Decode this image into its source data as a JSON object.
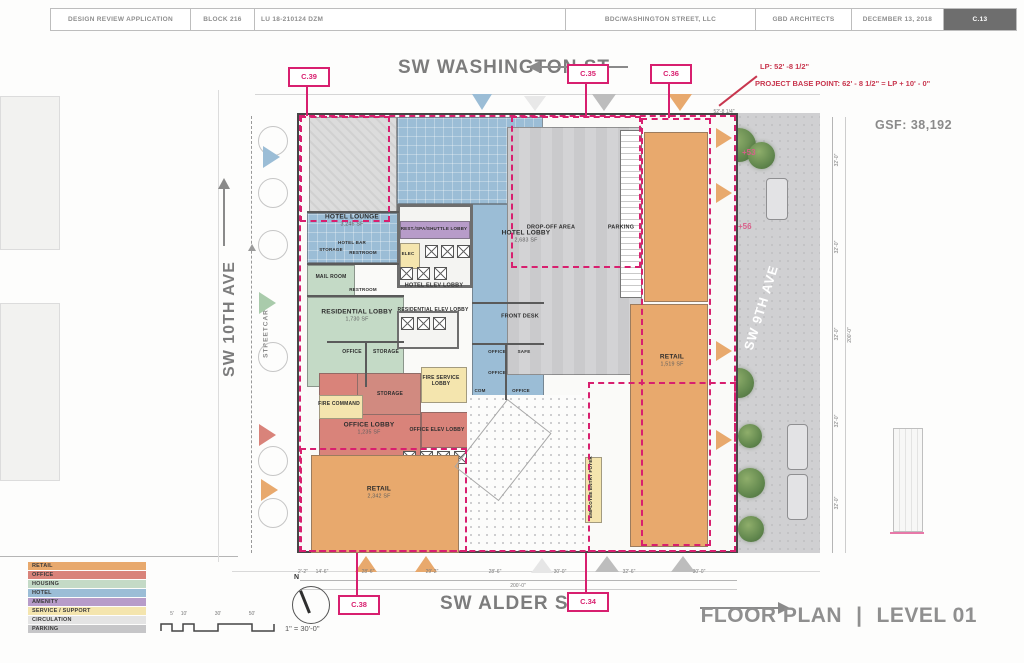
{
  "header": {
    "app": "DESIGN REVIEW APPLICATION",
    "block": "BLOCK 216",
    "case_no": "LU 18-210124 DZM",
    "owner": "BDC/WASHINGTON STREET, LLC",
    "architect": "GBD ARCHITECTS",
    "date": "DECEMBER 13, 2018",
    "sheet": "C.13"
  },
  "streets": {
    "north": "SW WASHINGTON ST",
    "south": "SW ALDER ST",
    "west": "SW 10TH AVE",
    "east": "SW 9TH AVE",
    "streetcar": "STREETCAR"
  },
  "callouts": {
    "c39": "C.39",
    "c35": "C.35",
    "c36": "C.36",
    "c38": "C.38",
    "c34": "C.34"
  },
  "annotations": {
    "lp": "LP: 52' -8 1/2\"",
    "base_point": "PROJECT BASE POINT: 62' - 8 1/2\" = LP + 10' - 0\"",
    "gsf": "GSF:  38,192",
    "spot_a": "+53",
    "spot_b": "+56",
    "top_dim": "52'-8 1/4\""
  },
  "rooms": {
    "hotel_lounge": {
      "label": "HOTEL LOUNGE",
      "sf": "3,246 SF"
    },
    "hotel_bar": {
      "label": "HOTEL BAR"
    },
    "storage_a": {
      "label": "STORAGE"
    },
    "restroom_a": {
      "label": "RESTROOM"
    },
    "restroom_b": {
      "label": "RESTROOM"
    },
    "mail_room": {
      "label": "MAIL ROOM"
    },
    "spa_lobby": {
      "label": "REST./SPA/SHUTTLE LOBBY"
    },
    "elec": {
      "label": "ELEC"
    },
    "hotel_lobby": {
      "label": "HOTEL LOBBY",
      "sf": "2,683 SF"
    },
    "hotel_elev_lobby": {
      "label": "HOTEL ELEV LOBBY"
    },
    "res_elev_lobby": {
      "label": "RESIDENTIAL ELEV LOBBY"
    },
    "res_lobby": {
      "label": "RESIDENTIAL LOBBY",
      "sf": "1,730 SF"
    },
    "office_a": {
      "label": "OFFICE"
    },
    "storage_b": {
      "label": "STORAGE"
    },
    "front_desk": {
      "label": "FRONT DESK"
    },
    "office_b": {
      "label": "OFFICE"
    },
    "safe": {
      "label": "SAFE"
    },
    "office_c": {
      "label": "OFFICE"
    },
    "com": {
      "label": "COM"
    },
    "office_d": {
      "label": "OFFICE"
    },
    "fire_service_lobby": {
      "label": "FIRE SERVICE LOBBY"
    },
    "storage_c": {
      "label": "STORAGE"
    },
    "fire_command": {
      "label": "FIRE COMMAND"
    },
    "office_lobby": {
      "label": "OFFICE LOBBY",
      "sf": "1,235 SF"
    },
    "office_elev_lobby": {
      "label": "OFFICE ELEV LOBBY"
    },
    "retail_sw": {
      "label": "RETAIL",
      "sf": "2,342 SF"
    },
    "dropoff": {
      "label": "DROP-OFF AREA"
    },
    "parking": {
      "label": "PARKING"
    },
    "retail_e": {
      "label": "RETAIL",
      "sf": "1,519 SF"
    },
    "employee_foyer": {
      "label": "EMPLOYEE ENTRY FOYER"
    }
  },
  "legend": {
    "items": [
      {
        "label": "RETAIL",
        "color": "#E8A96D"
      },
      {
        "label": "OFFICE",
        "color": "#D9837A"
      },
      {
        "label": "HOUSING",
        "color": "#C4DAC6"
      },
      {
        "label": "HOTEL",
        "color": "#9BBDD6"
      },
      {
        "label": "AMENITY",
        "color": "#B79CC9"
      },
      {
        "label": "SERVICE / SUPPORT",
        "color": "#F4E5AE"
      },
      {
        "label": "CIRCULATION",
        "color": "#E4E4E4"
      },
      {
        "label": "PARKING",
        "color": "#C6C6C8"
      }
    ]
  },
  "scale": {
    "north_label": "N",
    "marks": [
      "5'",
      "10'",
      "30'",
      "50'"
    ],
    "text": "1\" = 30'-0\""
  },
  "dims": {
    "bottom": [
      "2'-2\"",
      "14'-6\"",
      "28'-6\"",
      "29'-2\"",
      "28'-6\"",
      "30'-0\"",
      "32'-6\"",
      "30'-0\""
    ],
    "right_seg": "32'-0\"",
    "overall": "200'-0\""
  },
  "title": {
    "name": "FLOOR PLAN",
    "sep": "|",
    "level": "LEVEL 01"
  },
  "colors": {
    "accent_pink": "#D81F6F",
    "annotation_red": "#C8364E"
  }
}
